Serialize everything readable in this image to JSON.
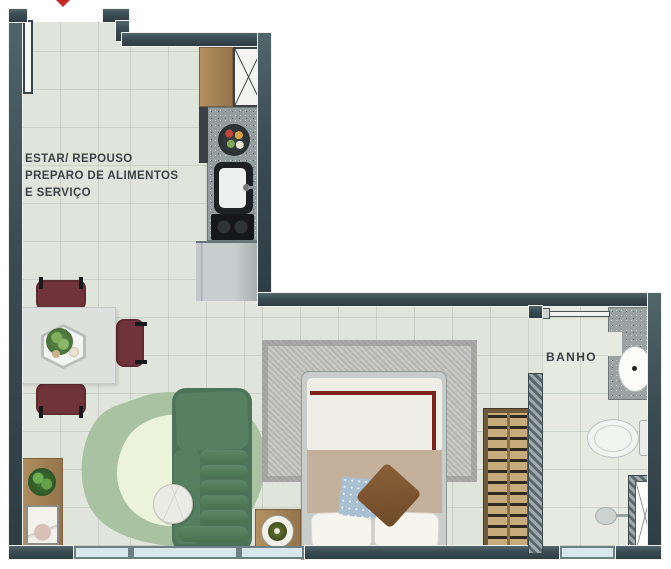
{
  "plan": {
    "type": "apartment-floor-plan",
    "labels": {
      "living_line1": "ESTAR/ REPOUSO",
      "living_line2": "PREPARO DE ALIMENTOS",
      "living_line3": "E SERVIÇO",
      "bathroom": "BANHO"
    },
    "rooms": [
      {
        "name": "estar-repouso-preparo-servico",
        "kind": "living-sleeping-kitchen-service"
      },
      {
        "name": "banho",
        "kind": "bathroom"
      }
    ],
    "furniture_icons": {
      "kitchen": [
        "tall-cabinet",
        "wood-counter",
        "granite-counter",
        "fruit-bowl",
        "sink",
        "cooktop",
        "refrigerator"
      ],
      "living": [
        "dining-table",
        "dining-chair",
        "hex-tray",
        "plant",
        "area-rug",
        "sofa",
        "round-coffee-table",
        "tv-console",
        "tv",
        "picture-frame"
      ],
      "bedroom": [
        "double-bed",
        "pillow",
        "cushion-blue",
        "cushion-brown",
        "bedroom-rug",
        "nightstand",
        "candle",
        "wardrobe"
      ],
      "bathroom": [
        "vanity-counter",
        "oval-sink",
        "toilet",
        "floor-drain",
        "shower-box",
        "sliding-door"
      ],
      "entry": [
        "entry-door",
        "entry-marker"
      ]
    },
    "colors": {
      "wall": "#3a4b51",
      "floor": "#e0e5db",
      "bath_floor": "#e6eae1",
      "window_glass": "#d7e6ea",
      "granite": "#949d9d",
      "wood": "#a5835a",
      "chair_maroon": "#6f3339",
      "sofa_green": "#4d7459",
      "rug_outer_green": "#a9c2a2",
      "rug_inner_green": "#ebf4da",
      "bed_band_beige": "#c3b19b",
      "bed_stripe_red": "#7c241c",
      "bedroom_rug_gray": "#b5b5b1",
      "entry_marker_red": "#c32b24"
    }
  }
}
